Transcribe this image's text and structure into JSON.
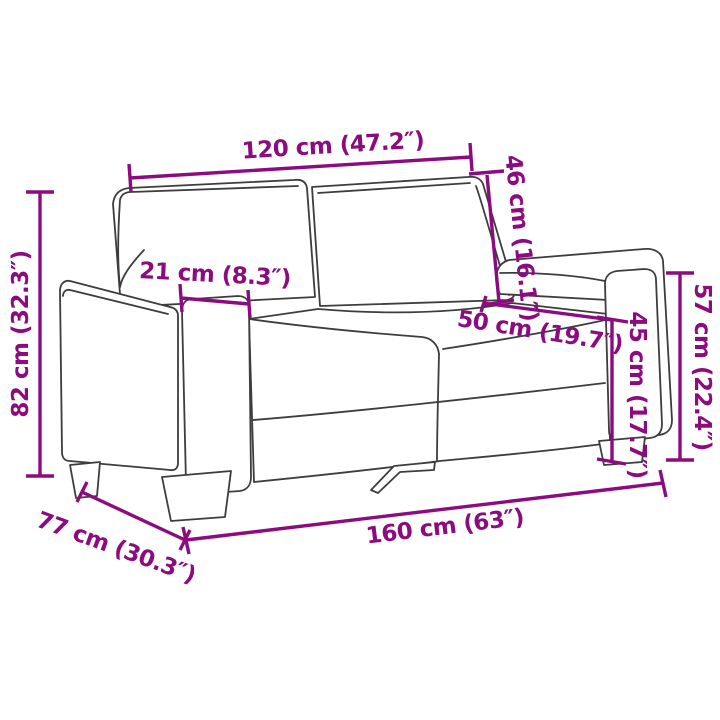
{
  "diagram": {
    "subject": "two-seater sofa dimension drawing"
  },
  "dimensions": {
    "back_width": "120 cm (47.2″)",
    "backrest_height": "46 cm (16.1″)",
    "overall_height": "82 cm (32.3″)",
    "armrest_width": "21 cm (8.3″)",
    "seat_depth": "50 cm (19.7″)",
    "seat_height": "45 cm (17.7″)",
    "armrest_height": "57 cm (22.4″)",
    "overall_width": "160 cm (63″)",
    "overall_depth": "77 cm (30.3″)"
  },
  "colors": {
    "dimension": "#8C0B7F",
    "line-art": "#3D3D3D",
    "background": "#FFFFFF"
  }
}
